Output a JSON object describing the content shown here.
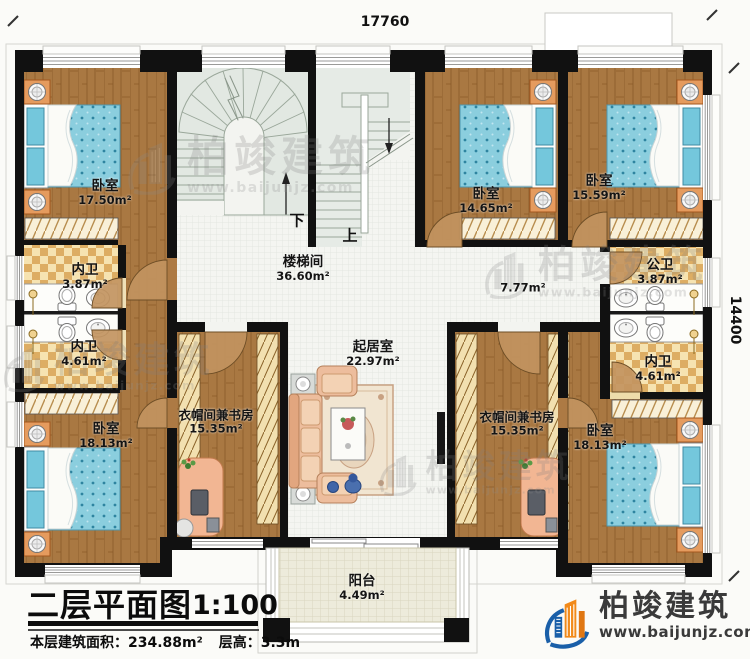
{
  "plan": {
    "dimensions": {
      "top": "17760",
      "right": "14400"
    },
    "stairs": {
      "down": "下",
      "up": "上"
    },
    "rooms": [
      {
        "id": "bedroom-top-left",
        "name": "卧室",
        "area": "17.50m²"
      },
      {
        "id": "bath-left-1",
        "name": "内卫",
        "area": "3.87m²"
      },
      {
        "id": "bath-left-2",
        "name": "内卫",
        "area": "4.61m²"
      },
      {
        "id": "bedroom-bottom-left",
        "name": "卧室",
        "area": "18.13m²"
      },
      {
        "id": "cloak-study-left",
        "name": "衣帽间兼书房",
        "area": "15.35m²"
      },
      {
        "id": "stair-hall",
        "name": "楼梯间",
        "area": "36.60m²"
      },
      {
        "id": "living-room",
        "name": "起居室",
        "area": "22.97m²"
      },
      {
        "id": "corridor",
        "name": "",
        "area": "7.77m²"
      },
      {
        "id": "bedroom-top-mid",
        "name": "卧室",
        "area": "14.65m²"
      },
      {
        "id": "bedroom-top-right",
        "name": "卧室",
        "area": "15.59m²"
      },
      {
        "id": "bath-public-right",
        "name": "公卫",
        "area": "3.87m²"
      },
      {
        "id": "bath-right",
        "name": "内卫",
        "area": "4.61m²"
      },
      {
        "id": "cloak-study-right",
        "name": "衣帽间兼书房",
        "area": "15.35m²"
      },
      {
        "id": "bedroom-bottom-right",
        "name": "卧室",
        "area": "18.13m²"
      },
      {
        "id": "balcony",
        "name": "阳台",
        "area": "4.49m²"
      }
    ]
  },
  "footer": {
    "title": "二层平面图",
    "scale": "1:100",
    "area_label": "本层建筑面积：",
    "area_value": "234.88m²",
    "height_label": "层高：",
    "height_value": "3.3m"
  },
  "brand": {
    "name": "柏竣建筑",
    "url": "www.baijunjz.com"
  },
  "watermark": {
    "text": "柏竣建筑",
    "url": "www.baijunjz.com"
  },
  "colors": {
    "wall": "#111111",
    "wood": "#a97842",
    "tile": "#ddad63",
    "mattress": "#8bcede",
    "brand_blue": "#1a5fa8",
    "brand_orange": "#f28a1a"
  }
}
